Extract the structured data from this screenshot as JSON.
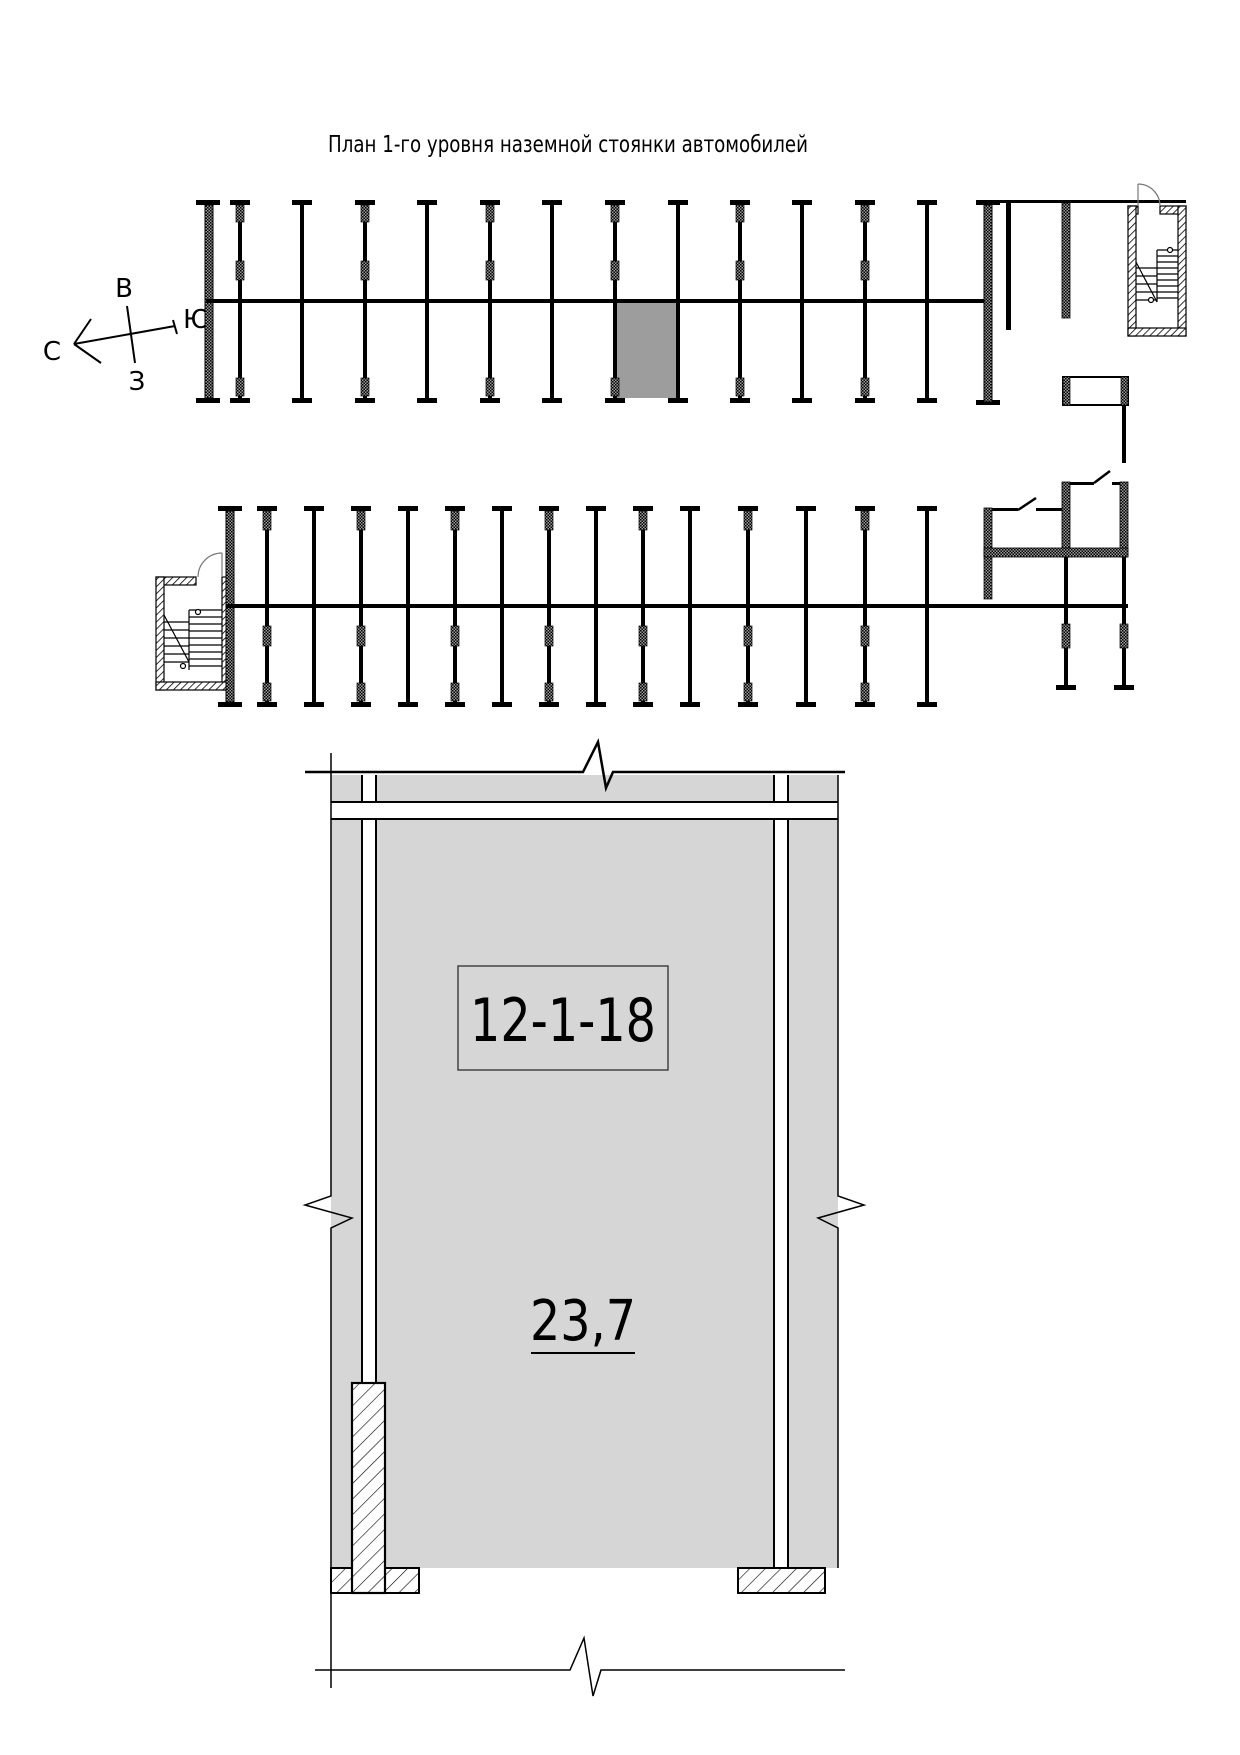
{
  "drawing": {
    "title": "План 1-го уровня наземной стоянки автомобилей",
    "compass": {
      "east_label": "В",
      "south_label": "Ю",
      "north_label": "С",
      "west_label": "З"
    },
    "space": {
      "id": "12-1-18",
      "area_m2": "23,7"
    },
    "colors": {
      "highlight_fill": "#9d9d9d",
      "detail_fill": "#d6d6d6",
      "line_color": "#000000"
    }
  }
}
